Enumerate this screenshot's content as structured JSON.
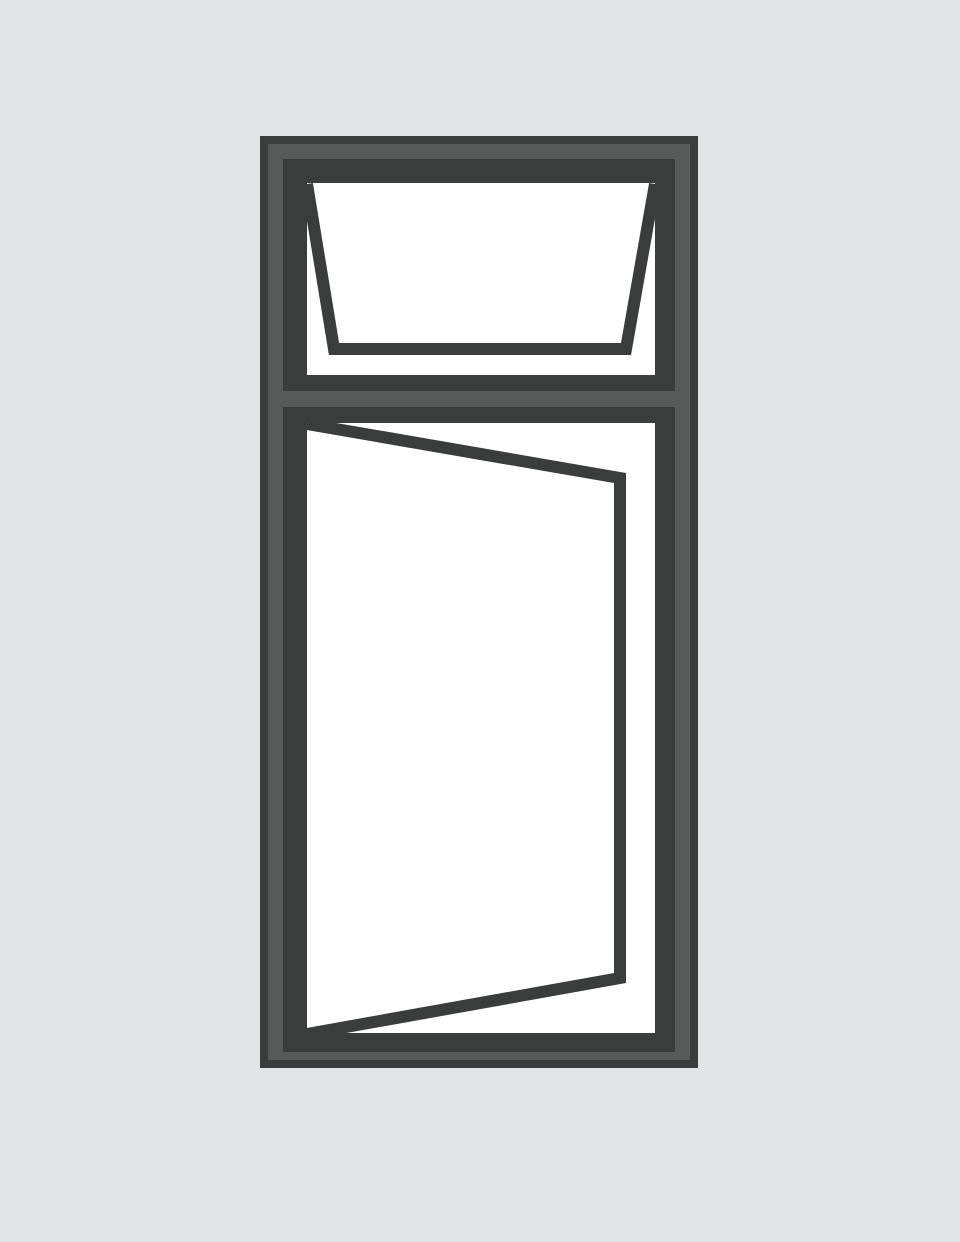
{
  "illustration": {
    "subject": "open-window-style-diagram",
    "canvas": {
      "width": 960,
      "height": 1242
    },
    "colors": {
      "background": "#e2e5e6",
      "frame_dark": "#3b3d3c",
      "frame_mid": "#575a59",
      "glass": "#ffffff"
    },
    "frame_outer": {
      "x": 260,
      "y": 136,
      "width": 438,
      "height": 932
    },
    "frame_mid_band": {
      "x": 268,
      "y": 144,
      "width": 422,
      "height": 916
    },
    "top_pane_frame": {
      "x": 283,
      "y": 159,
      "width": 392,
      "height": 232
    },
    "bottom_pane_frame": {
      "x": 283,
      "y": 407,
      "width": 392,
      "height": 645
    },
    "top_pane_glass": {
      "x": 307,
      "y": 183,
      "width": 348,
      "height": 192
    },
    "bottom_pane_glass": {
      "x": 307,
      "y": 423,
      "width": 348,
      "height": 610
    },
    "top_sash_open": {
      "points": "307,184 334,349 626,349 655,184",
      "stroke_width": 12
    },
    "bottom_sash_open": {
      "points": "307,424 620,478 620,978 307,1034",
      "stroke_width": 12
    }
  }
}
